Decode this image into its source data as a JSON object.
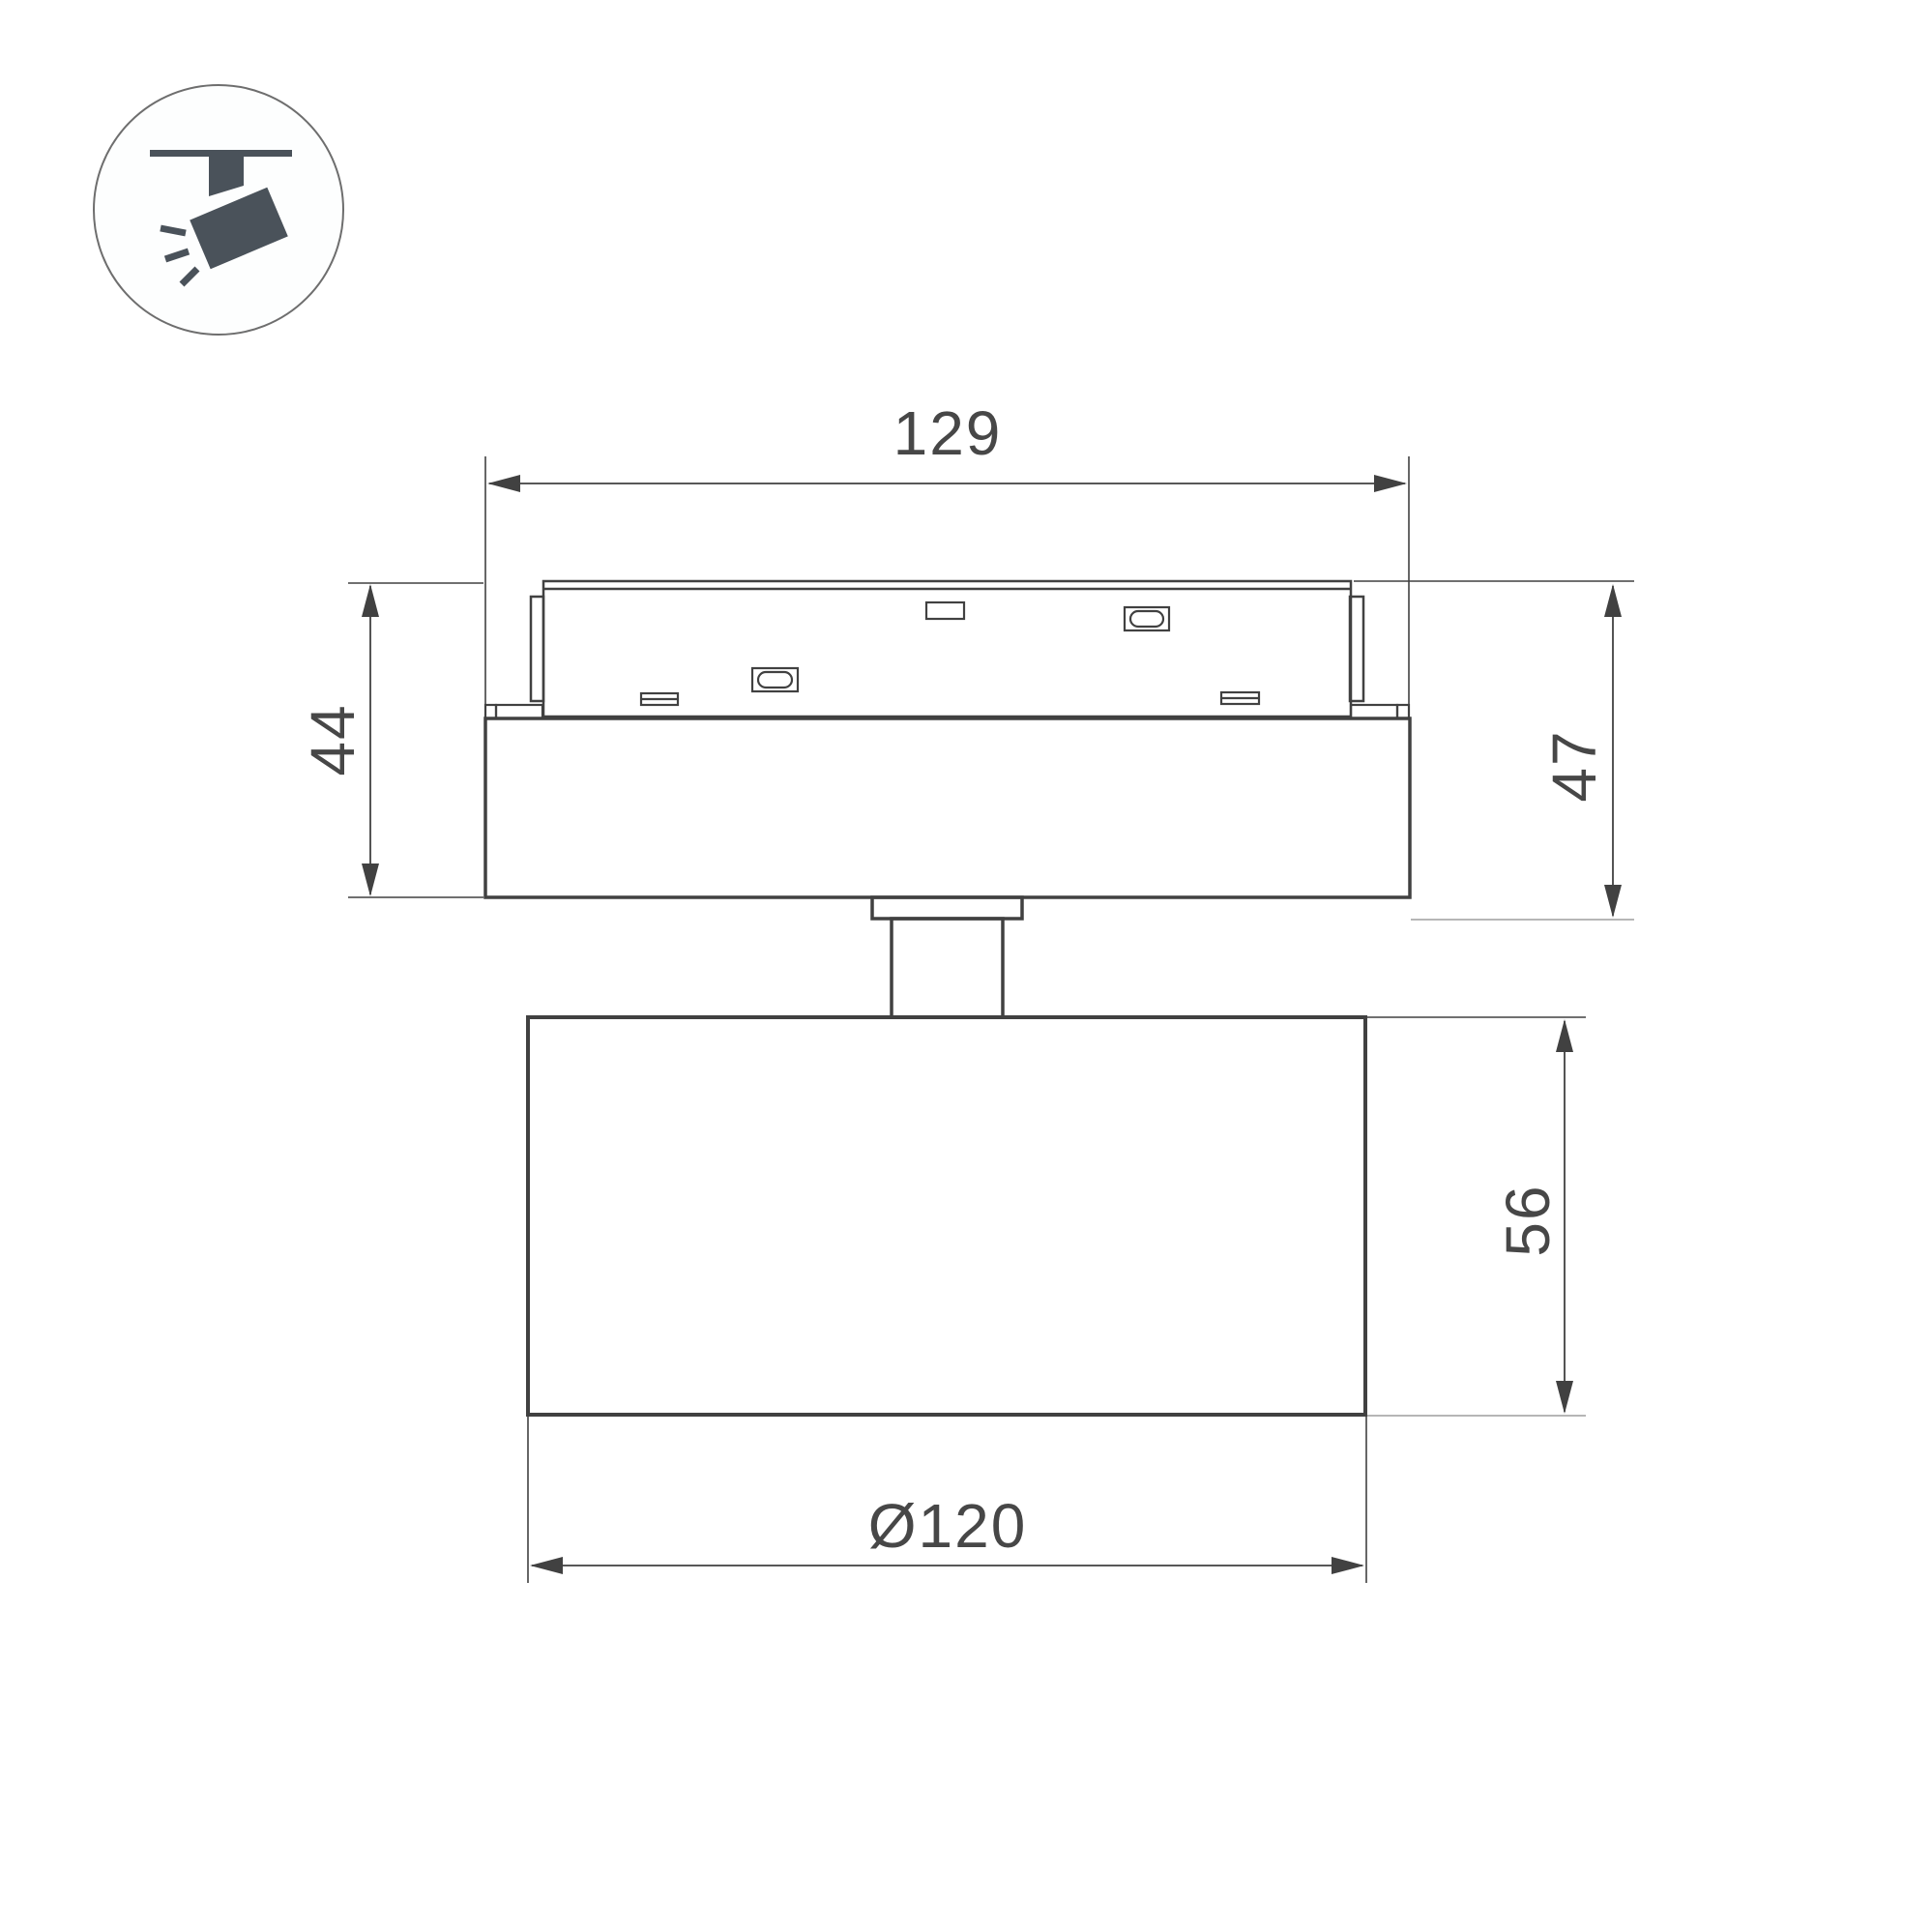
{
  "theme": {
    "page-bg": "#ffffff",
    "ink": "#414141",
    "light-line": "#9e9e9e",
    "icon-color": "#4a525a",
    "icon-circle": "#6e6e6e",
    "text-color": "#474747"
  },
  "icon": {
    "type": "ceiling-track-spotlight-pictogram"
  },
  "dimensions": {
    "adapter_width": "129",
    "adapter_height": "44",
    "overall_mount_height": "47",
    "head_height": "56",
    "head_diameter": "Ø120"
  }
}
